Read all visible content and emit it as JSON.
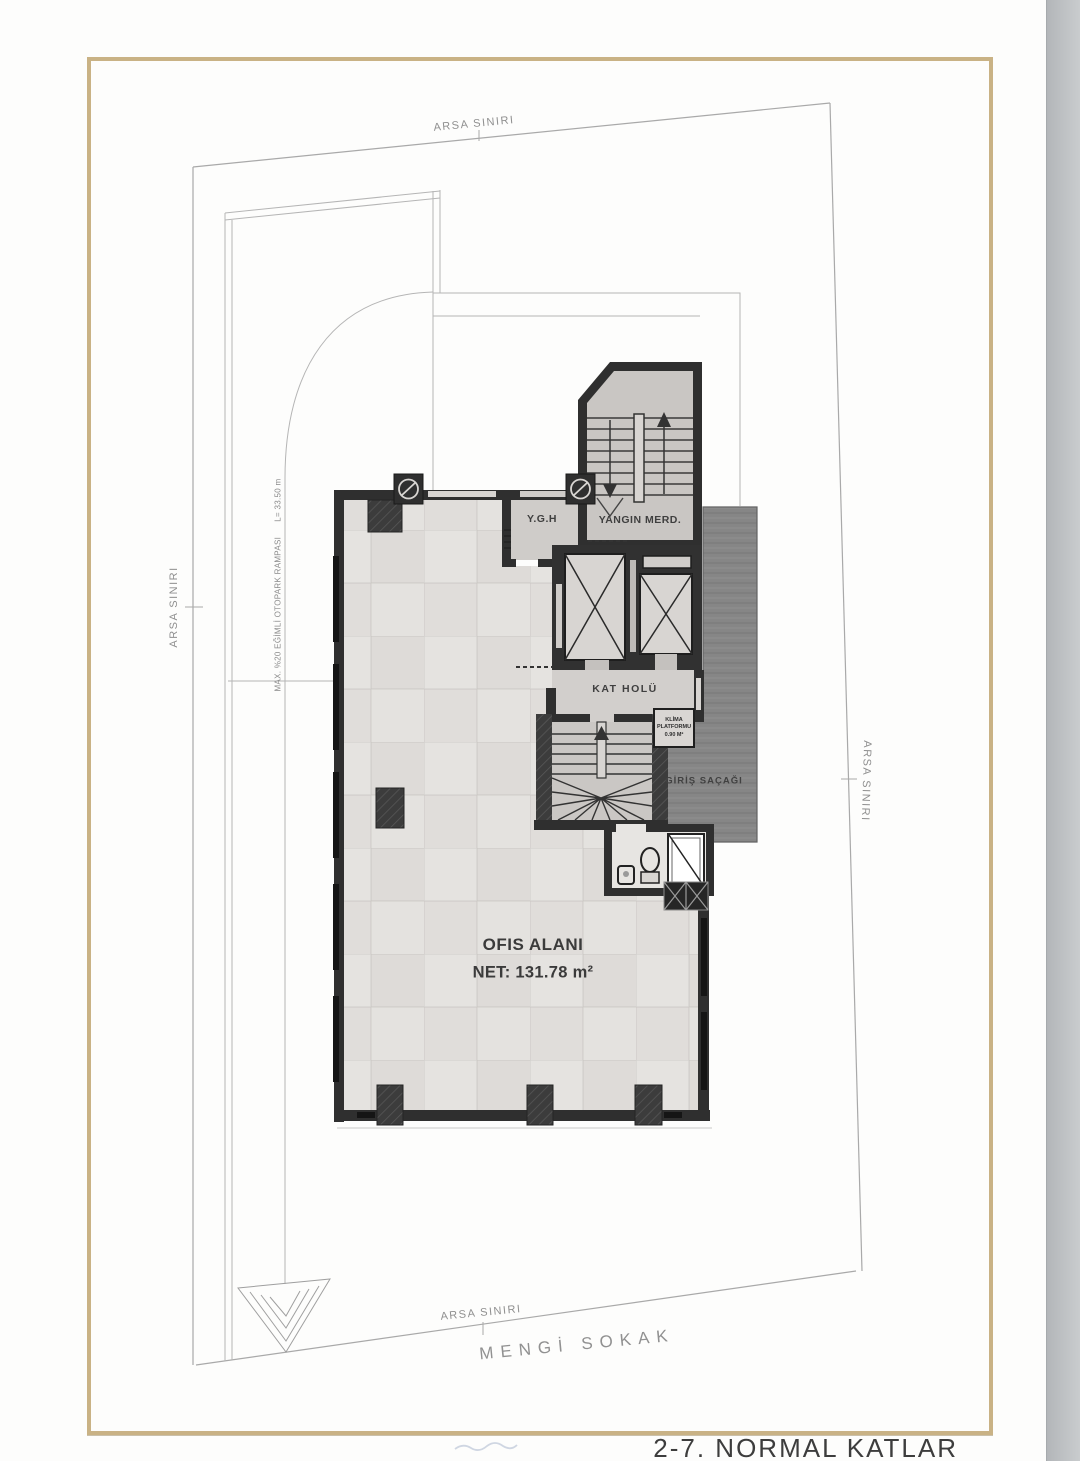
{
  "drawing_title": "2-7. NORMAL KATLAR",
  "site": {
    "boundary_top": "ARSA SINIRI",
    "boundary_left": "ARSA SINIRI",
    "boundary_right": "ARSA SINIRI",
    "boundary_bottom": "ARSA SINIRI",
    "street": "MENGİ SOKAK",
    "ramp": "MAX. %20 EĞİMLİ OTOPARK RAMPASI      L= 33.50 m"
  },
  "rooms": {
    "ygh": "Y.G.H",
    "fire_stairs": "YANGIN MERD.",
    "hall": "KAT HOLÜ",
    "canopy": "GİRİŞ SAÇAĞI",
    "office_name": "OFIS ALANI",
    "office_area": "NET: 131.78 m²",
    "ac_platform": {
      "line1": "KLİMA",
      "line2": "PLATFORMU",
      "line3": "0.90 M²"
    }
  },
  "colors": {
    "frame_gold": "#c9b285",
    "wall_dark": "#2f2f2f",
    "canopy_gray": "#868686",
    "floor_tile": "#e3e1de",
    "site_line": "#a9a9a9",
    "label_dark": "#3d3d3d",
    "label_gray": "#8f8f8f"
  }
}
